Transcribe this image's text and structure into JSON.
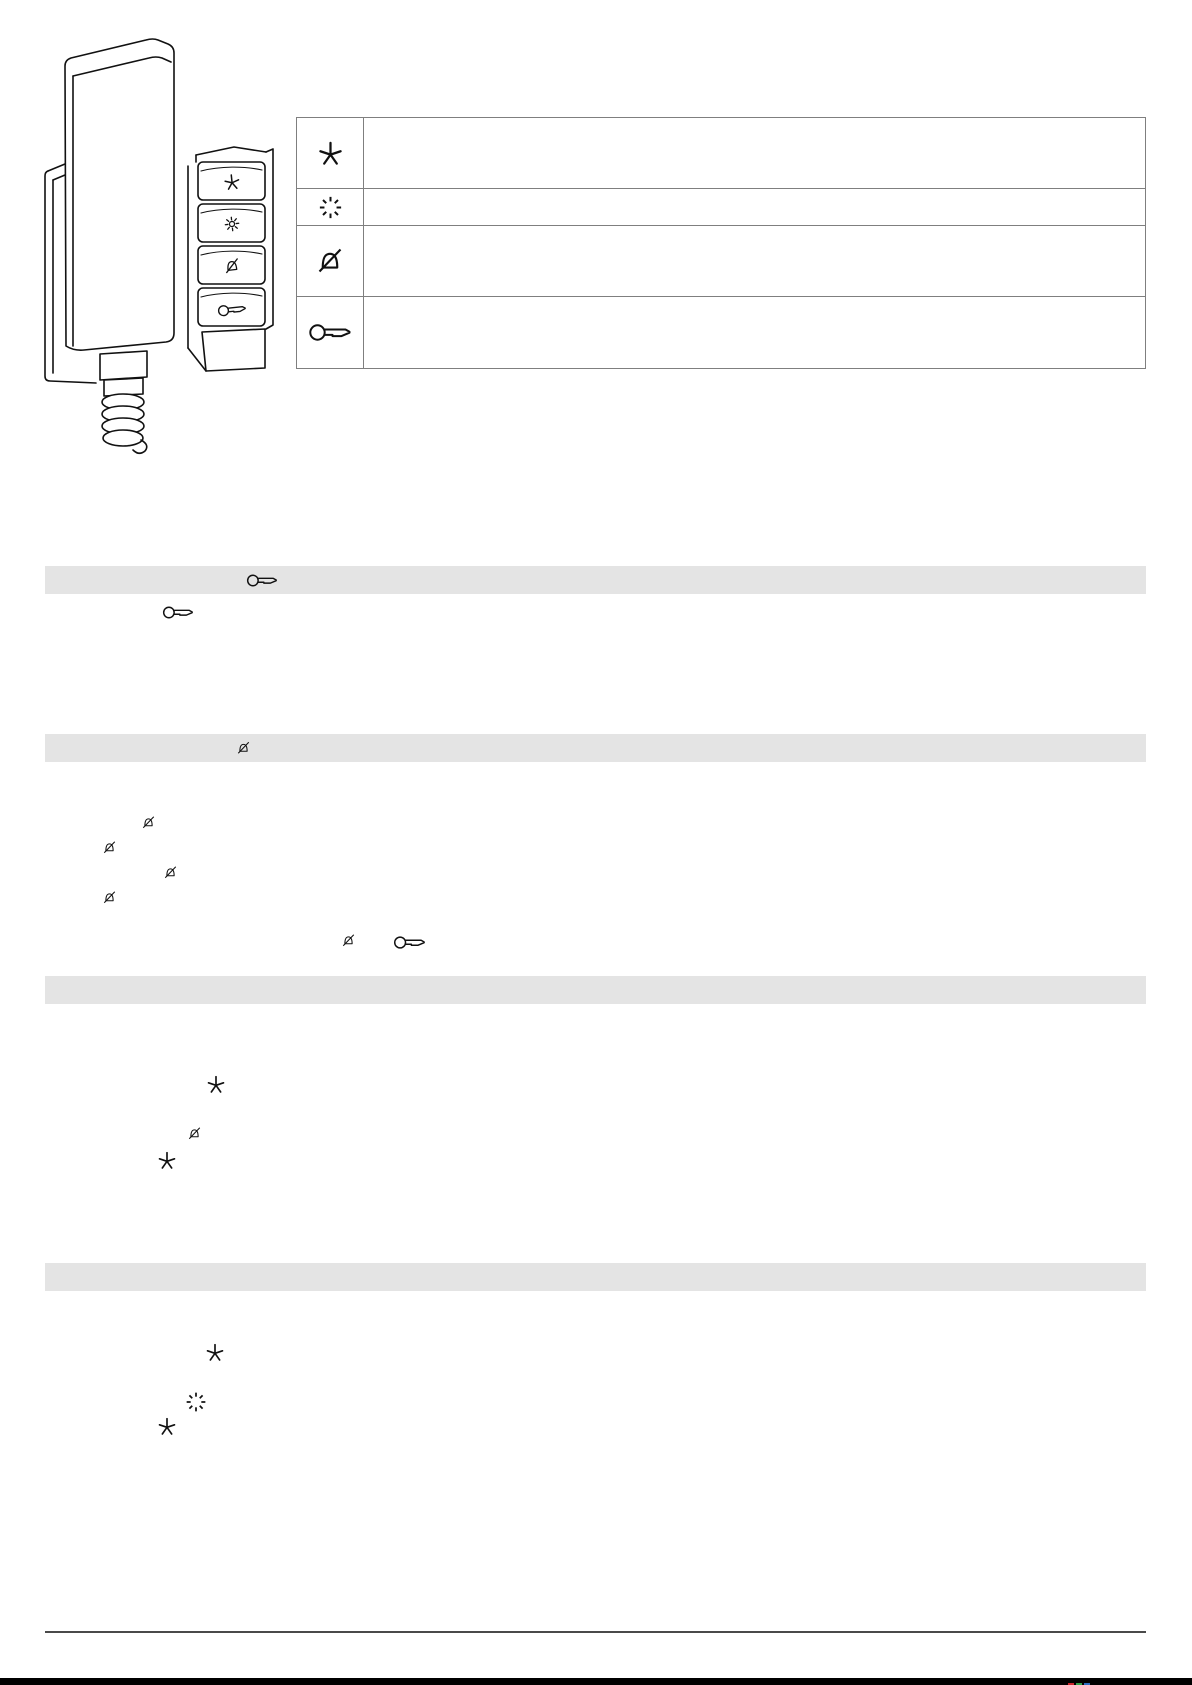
{
  "page": {
    "width": 1192,
    "height": 1685,
    "background": "#ffffff"
  },
  "colors": {
    "line_art": "#111111",
    "table_border": "#7f7f7f",
    "section_bar": "#e4e4e4",
    "footer_rule": "#4a4a4a",
    "footer_bar": "#000000"
  },
  "device_figure": {
    "label": "wall-mounted-intercom-handset-with-function-buttons",
    "button_icons": [
      "star-icon",
      "light-icon",
      "ringer-off-icon",
      "door-key-icon"
    ]
  },
  "legend_table": {
    "rows": [
      {
        "icon": "star-icon",
        "text": ""
      },
      {
        "icon": "blink-icon",
        "text": ""
      },
      {
        "icon": "ringer-off-icon",
        "text": ""
      },
      {
        "icon": "door-key-icon",
        "text": ""
      }
    ]
  },
  "sections": [
    {
      "bar_icon": "door-key-icon",
      "body_icons": [
        "door-key-icon"
      ]
    },
    {
      "bar_icon": "ringer-off-icon",
      "body_icons": [
        "ringer-off-icon",
        "ringer-off-icon",
        "ringer-off-icon",
        "ringer-off-icon",
        "ringer-off-icon",
        "door-key-icon"
      ]
    },
    {
      "bar_icon": "",
      "body_icons": [
        "star-icon",
        "ringer-off-icon",
        "star-icon"
      ]
    },
    {
      "bar_icon": "",
      "body_icons": [
        "star-icon",
        "blink-icon",
        "star-icon"
      ]
    }
  ],
  "footer": {
    "print_mark_colors": [
      "#c9252c",
      "#2f9e48",
      "#2a6bbf"
    ]
  }
}
